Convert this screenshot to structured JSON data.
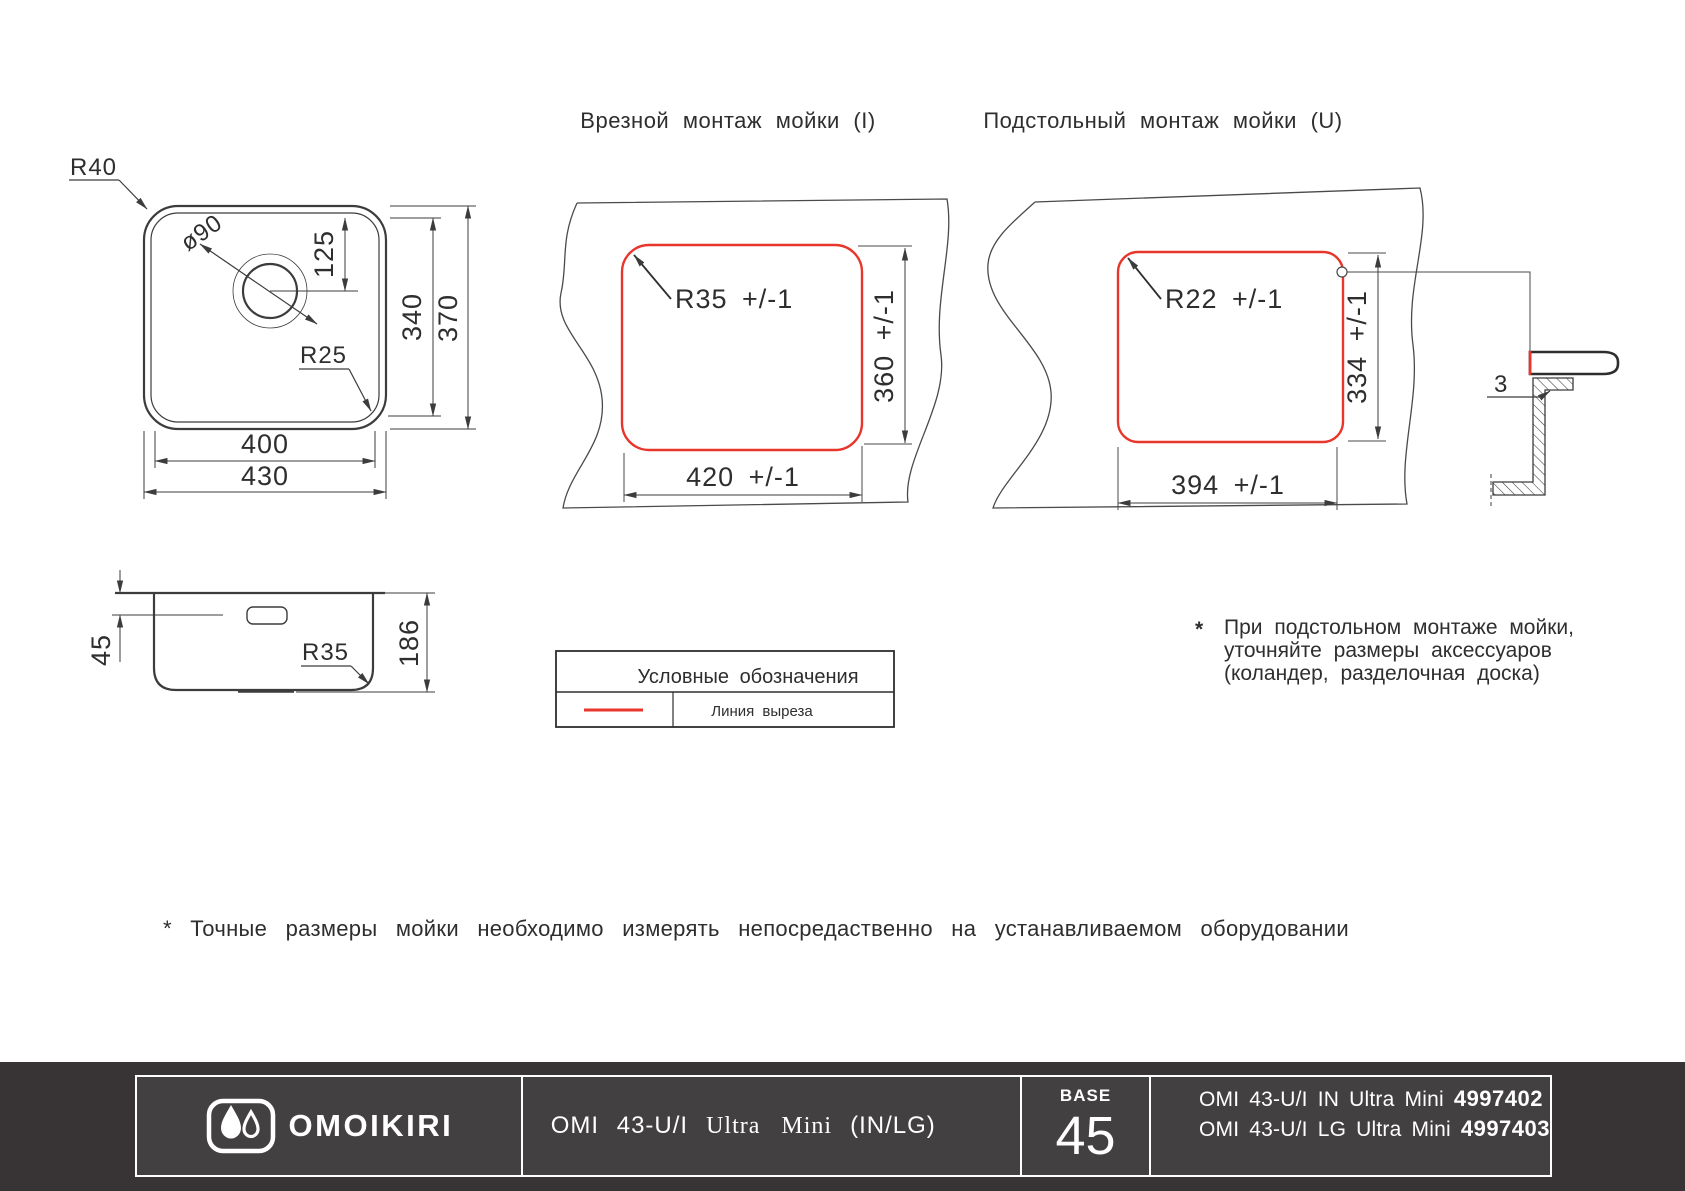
{
  "colors": {
    "cut_line_red": "#e8362c",
    "drawing_line": "#3c3c3c",
    "footer_bg": "#383435",
    "footer_cell_bg": "#434041"
  },
  "drawing": {
    "plan": {
      "r40": "R40",
      "d90": "ø90",
      "r25": "R25",
      "d125": "125",
      "d340": "340",
      "d370": "370",
      "d400": "400",
      "d430": "430"
    },
    "side": {
      "d45": "45",
      "r35": "R35",
      "d186": "186"
    },
    "inset": {
      "title": "Врезной монтаж мойки (I)",
      "corner": "R35 +/-1",
      "h": "360 +/-1",
      "w": "420 +/-1"
    },
    "under": {
      "title": "Подстольный монтаж мойки (U)",
      "corner": "R22 +/-1",
      "h": "334 +/-1",
      "w": "394 +/-1",
      "rim": "3"
    },
    "legend": {
      "title": "Условные обозначения",
      "cut": "Линия выреза"
    },
    "notes": {
      "under_star": "*",
      "under_lines": [
        "При подстольном монтаже мойки,",
        "уточняйте размеры аксессуаров",
        "(коландер, разделочная доска)"
      ],
      "bottom": "* Точные размеры мойки необходимо измерять непосредаственно на устанавливаемом оборудовании"
    }
  },
  "footer": {
    "brand": "OMOIKIRI",
    "product": {
      "model": "OMI 43-U/I",
      "name": "Ultra Mini",
      "finishes": "(IN/LG)"
    },
    "base_label": "BASE",
    "base_value": "45",
    "skus": [
      {
        "line": "OMI 43-U/I IN Ultra Mini",
        "code": "4997402"
      },
      {
        "line": "OMI 43-U/I LG Ultra Mini",
        "code": "4997403"
      }
    ]
  }
}
